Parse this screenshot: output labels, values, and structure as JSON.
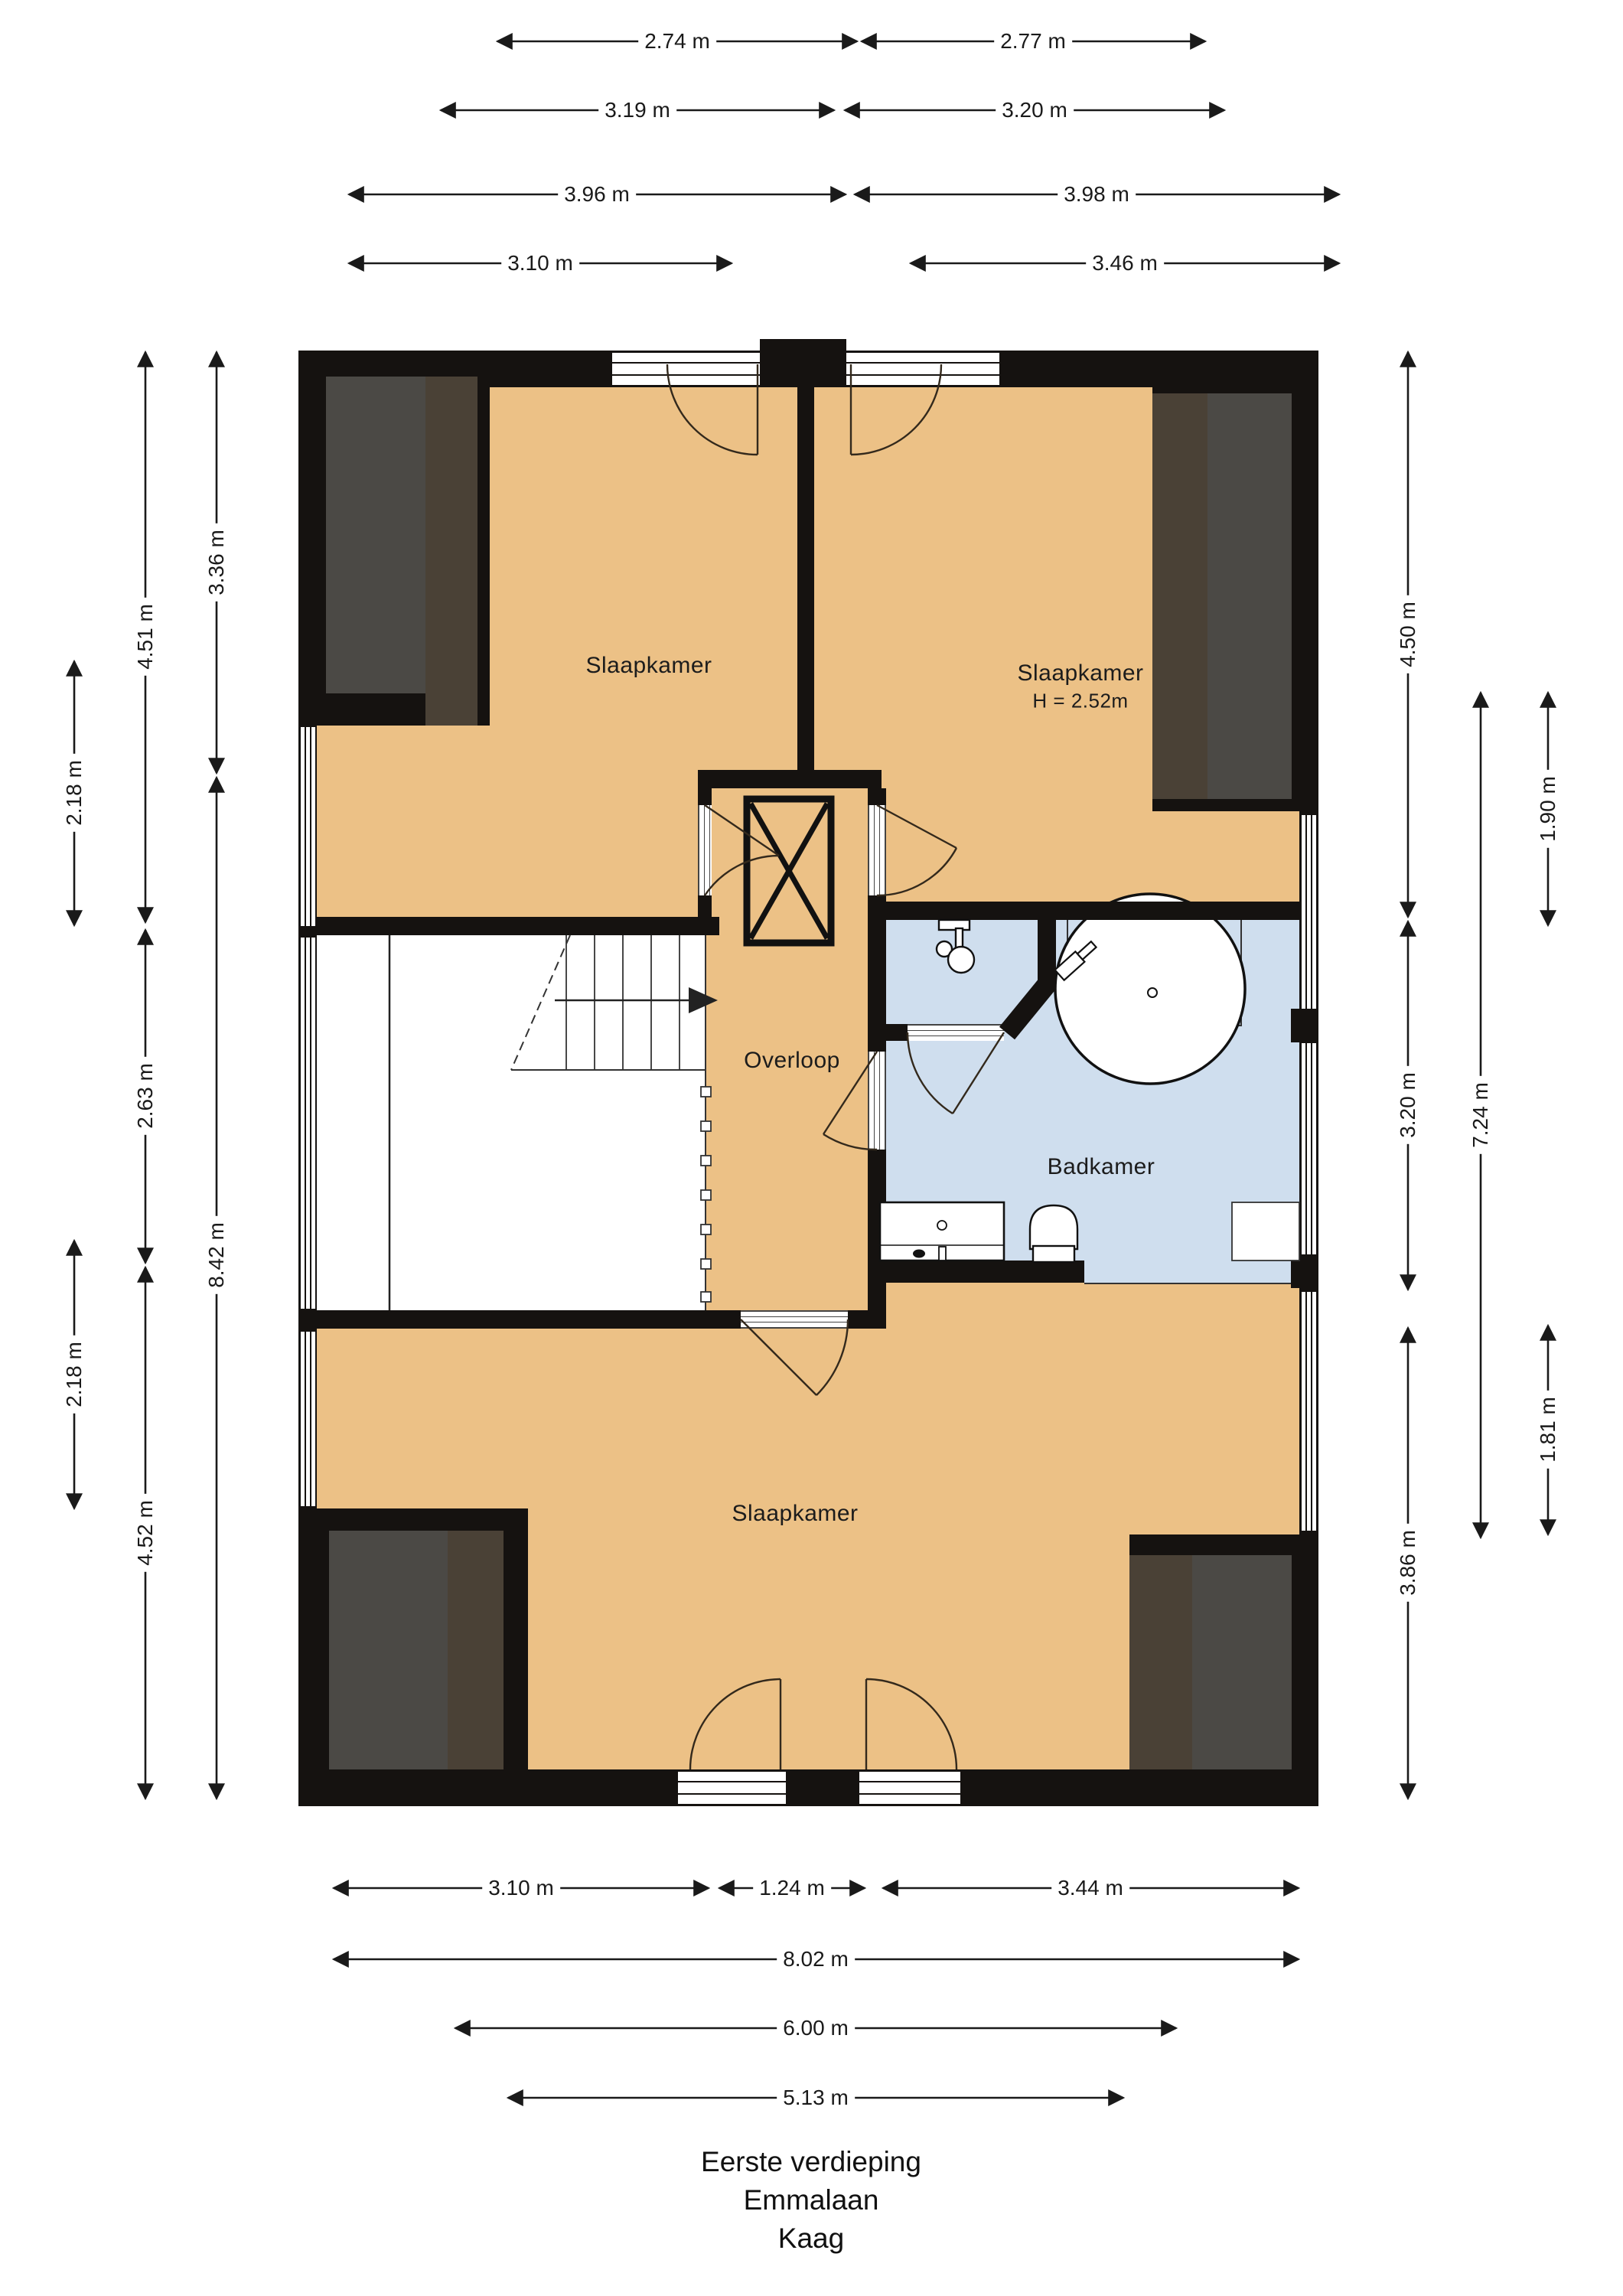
{
  "title": {
    "line1": "Eerste verdieping",
    "line2": "Emmalaan",
    "line3": "Kaag"
  },
  "rooms": {
    "bedroom_top_left": "Slaapkamer",
    "bedroom_top_right": "Slaapkamer",
    "bedroom_top_right_height": "H = 2.52m",
    "landing": "Overloop",
    "bathroom": "Badkamer",
    "bedroom_bottom": "Slaapkamer"
  },
  "dims": {
    "t1a": "2.74 m",
    "t1b": "2.77 m",
    "t2a": "3.19 m",
    "t2b": "3.20 m",
    "t3a": "3.96 m",
    "t3b": "3.98 m",
    "t4a": "3.10 m",
    "t4b": "3.46 m",
    "b1a": "3.10 m",
    "b1b": "1.24 m",
    "b1c": "3.44 m",
    "b2": "8.02 m",
    "b3": "6.00 m",
    "b4": "5.13 m",
    "l_win_top": "2.18 m",
    "l_win_bottom": "2.18 m",
    "l_451": "4.51 m",
    "l_263": "2.63 m",
    "l_452": "4.52 m",
    "l_336": "3.36 m",
    "l_842": "8.42 m",
    "r_450": "4.50 m",
    "r_320": "3.20 m",
    "r_386": "3.86 m",
    "r_724": "7.24 m",
    "r_190": "1.90 m",
    "r_181": "1.81 m"
  },
  "colors": {
    "floor_orange": "#ecc186",
    "floor_blue": "#cfdeee",
    "wall_black": "#151210",
    "dormer_gray": "#4b4945",
    "dormer_brown": "#4a4136",
    "line_dark": "#1a1a1a"
  }
}
